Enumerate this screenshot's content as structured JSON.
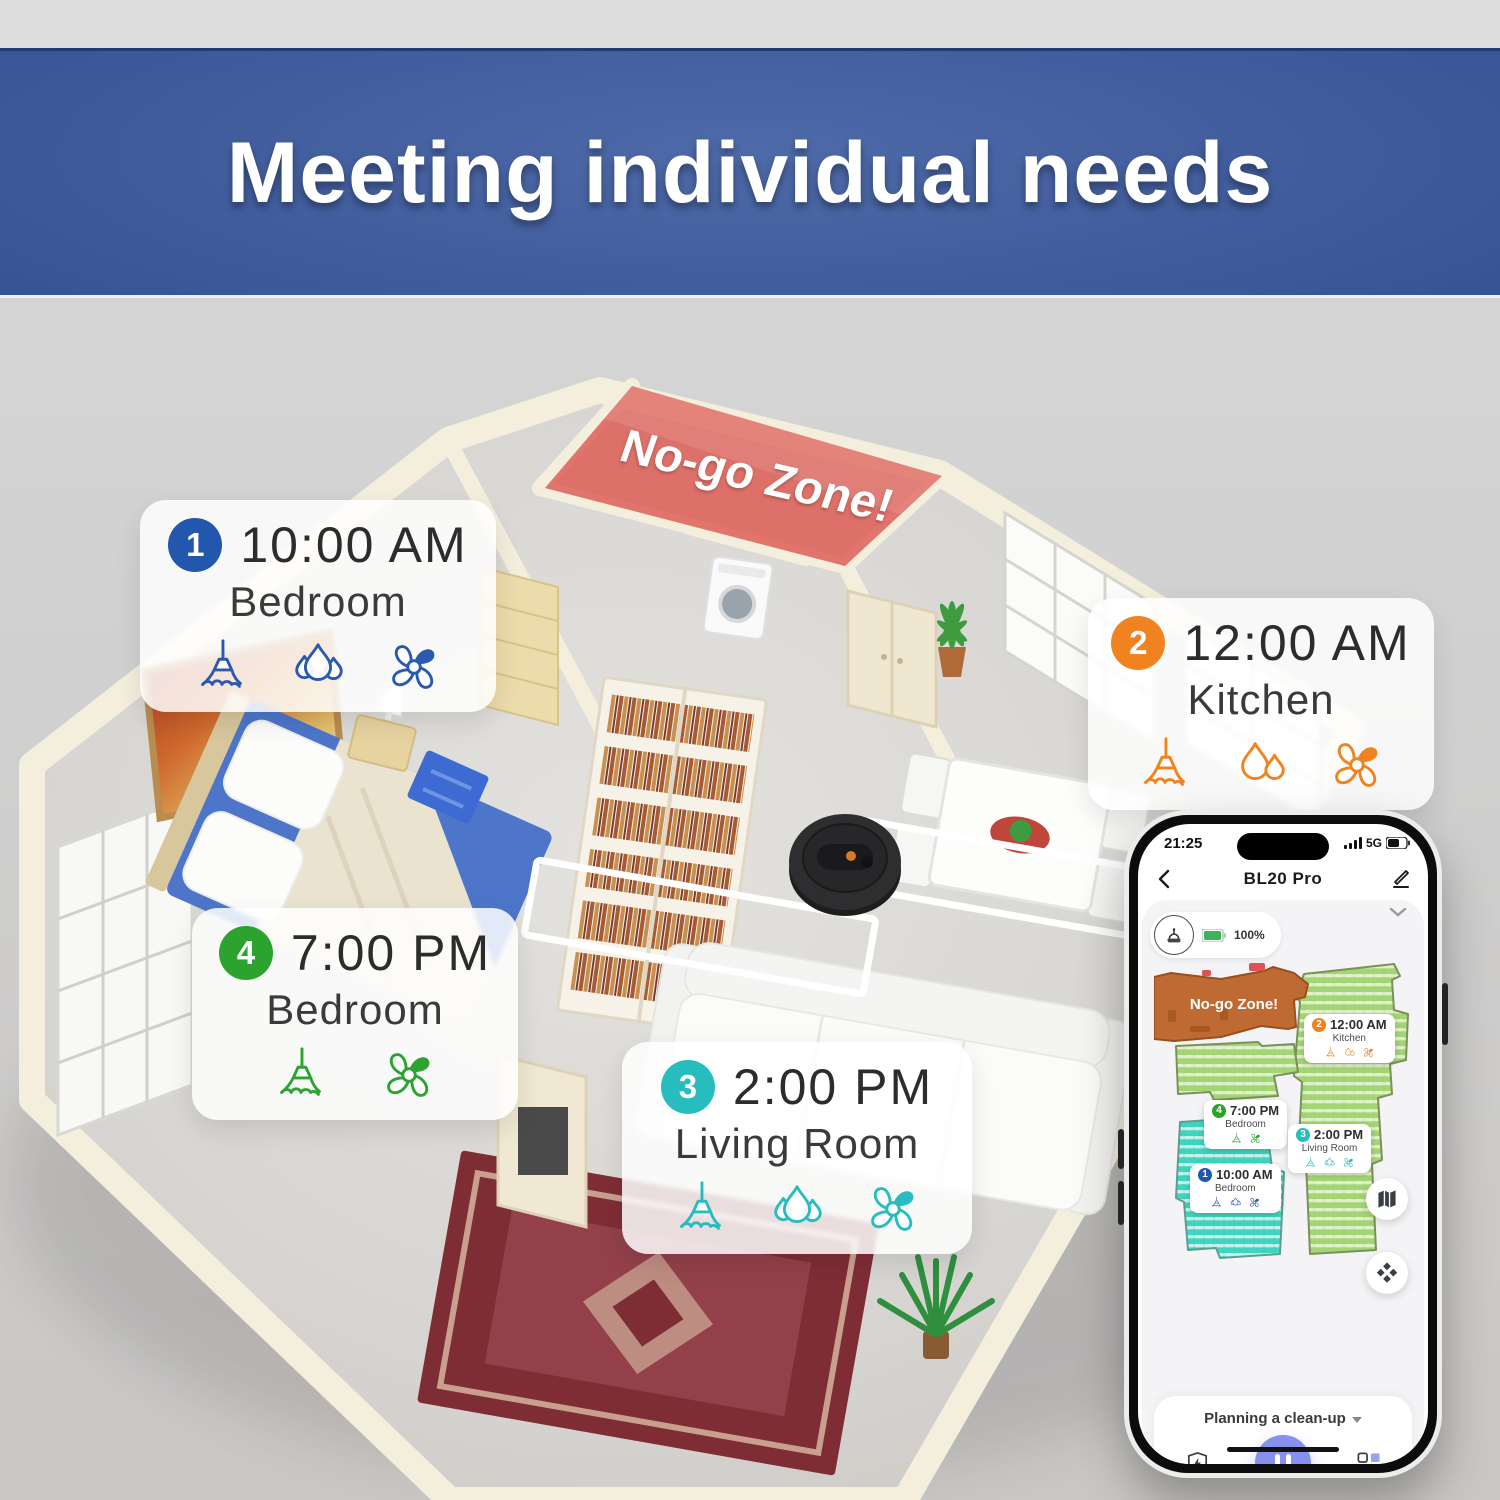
{
  "banner": {
    "title": "Meeting individual needs"
  },
  "colors": {
    "banner_blue": "#3a5697",
    "badge_blue": "#2357ae",
    "badge_orange": "#f0821f",
    "badge_green": "#2da32f",
    "badge_teal": "#29bcbe",
    "no_go_red": "#dd5a52",
    "map_no_go_orange": "#bf6a33",
    "map_green": "#a3d574",
    "map_teal": "#40d3bf",
    "pause_purple": "#8791ed",
    "battery_green": "#41b05a"
  },
  "floorplan": {
    "no_go_zone_label": "No-go Zone!",
    "cards": [
      {
        "num": "1",
        "time": "10:00 AM",
        "room": "Bedroom"
      },
      {
        "num": "2",
        "time": "12:00 AM",
        "room": "Kitchen"
      },
      {
        "num": "3",
        "time": "2:00 PM",
        "room": "Living Room"
      },
      {
        "num": "4",
        "time": "7:00 PM",
        "room": "Bedroom"
      }
    ]
  },
  "phone": {
    "status_bar": {
      "time": "21:25",
      "network": "5G"
    },
    "nav": {
      "title": "BL20 Pro"
    },
    "device": {
      "battery": "100%"
    },
    "map": {
      "no_go_label": "No-go Zone!",
      "labels": [
        {
          "num": "2",
          "time": "12:00 AM",
          "room": "Kitchen"
        },
        {
          "num": "4",
          "time": "7:00 PM",
          "room": "Bedroom"
        },
        {
          "num": "3",
          "time": "2:00 PM",
          "room": "Living Room"
        },
        {
          "num": "1",
          "time": "10:00 AM",
          "room": "Bedroom"
        }
      ]
    },
    "footer": {
      "mode_label": "Planning a clean-up"
    }
  }
}
